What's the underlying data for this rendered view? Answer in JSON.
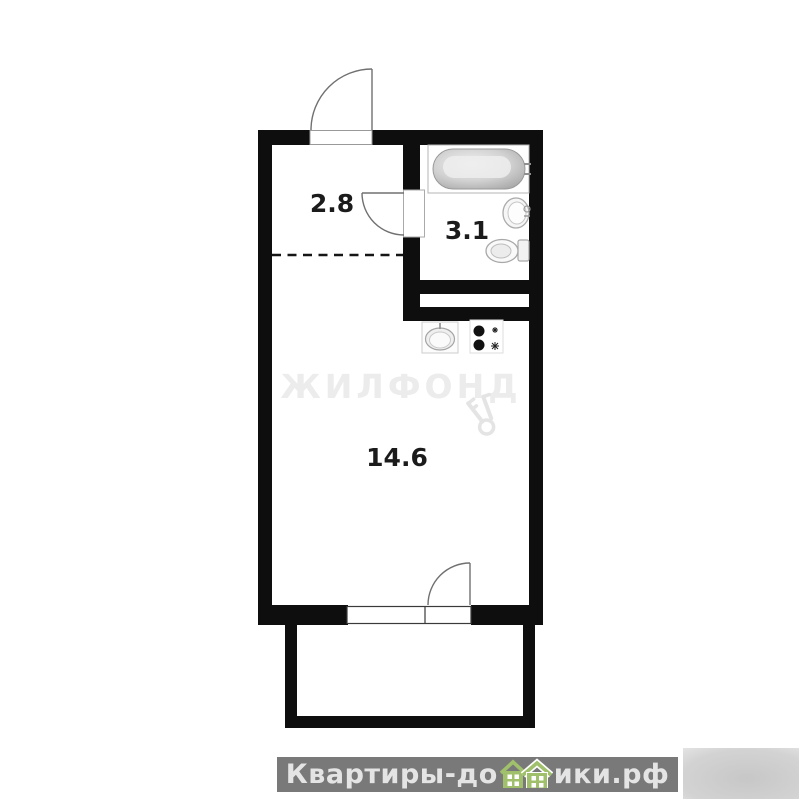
{
  "colors": {
    "wall": "#0e0e0e",
    "thin_line": "#707070",
    "watermark": "#ececec",
    "banner_bg": "#797979",
    "banner_text": "#e4e4e4",
    "house_green": "#a0c06c"
  },
  "floor_plan": {
    "rooms": [
      {
        "name": "hallway",
        "area": "2.8"
      },
      {
        "name": "bathroom",
        "area": "3.1"
      },
      {
        "name": "living-room",
        "area": "14.6"
      }
    ],
    "icons": [
      "bathtub-icon",
      "sink-icon",
      "toilet-icon",
      "kitchen-sink-icon",
      "stove-icon",
      "door-arc-icon",
      "key-icon",
      "house-icon"
    ]
  },
  "watermark": {
    "brand": "ЖИЛФОНД"
  },
  "footer": {
    "full_text": "Квартиры-домики.рф",
    "text_before_icon": "Квартиры-до",
    "text_after_icon": "ики.рф"
  }
}
